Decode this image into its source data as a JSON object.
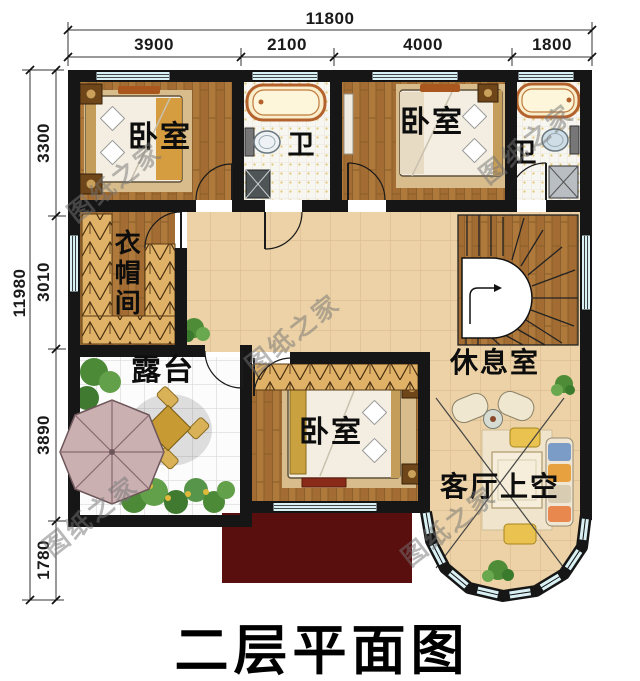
{
  "title": "二层平面图",
  "watermark": "图纸之家",
  "dimensions": {
    "top": {
      "total": "11800",
      "segments": [
        "3900",
        "2100",
        "4000",
        "1800"
      ]
    },
    "left": {
      "total": "11980",
      "segments": [
        "3300",
        "3010",
        "3890",
        "1780"
      ]
    }
  },
  "rooms": {
    "bedroom_top_left": "卧室",
    "bath_top": "卫",
    "bedroom_top_right": "卧室",
    "bath_right": "卫",
    "cloakroom": "衣帽间",
    "terrace": "露台",
    "bedroom_bottom": "卧室",
    "lounge": "休息室",
    "living_room_void": "客厅上空"
  },
  "colors": {
    "wall": "#161616",
    "wood_floor": "#b0793c",
    "hall_tile": "#ecd2a6",
    "terrace_tile": "#fcfcfc",
    "window": "#d9f0f4",
    "roof": "#5a0f0f",
    "wardrobe": "#e0b268",
    "greenery": "#4c8a38",
    "umbrella": "#cbb0b2"
  }
}
